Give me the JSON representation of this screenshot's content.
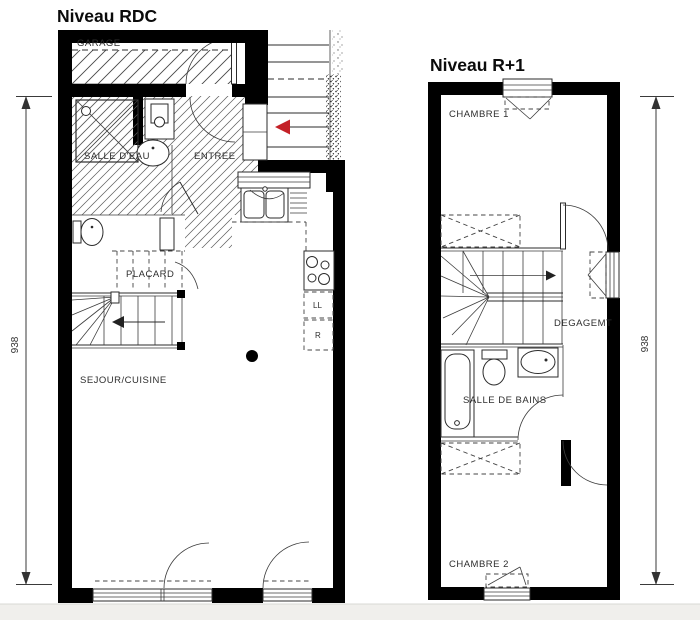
{
  "page": {
    "background": "#ffffff",
    "footer_band_color": "#f0efec"
  },
  "rdc": {
    "title": "Niveau RDC",
    "labels": {
      "garage": "GARAGE",
      "salle_deau": "SALLE D'EAU",
      "entree": "ENTREE",
      "placard": "PLACARD",
      "sejour_cuisine": "SEJOUR/CUISINE",
      "lave_linge": "LL",
      "refrigerateur": "R"
    },
    "dimension": "938"
  },
  "r1": {
    "title": "Niveau R+1",
    "labels": {
      "chambre1": "CHAMBRE 1",
      "degagement": "DEGAGEMT",
      "salle_de_bains": "SALLE DE BAINS",
      "chambre2": "CHAMBRE 2"
    },
    "dimension": "938"
  },
  "colors": {
    "wall": "#000000",
    "stair_arrow_red": "#c42127"
  }
}
